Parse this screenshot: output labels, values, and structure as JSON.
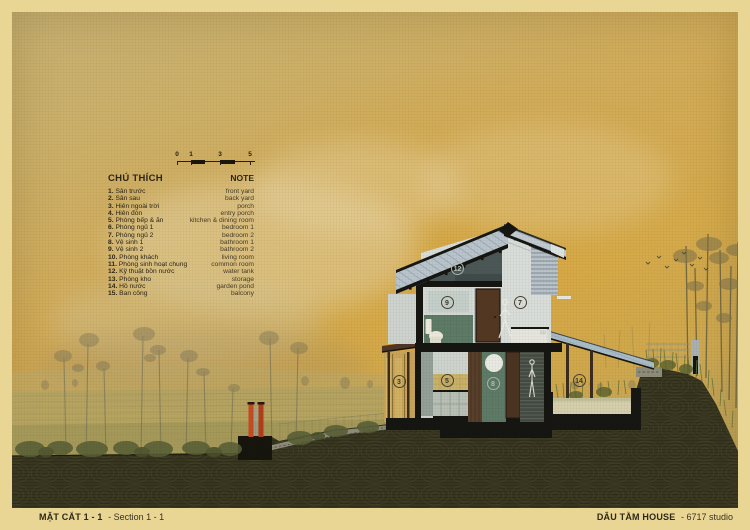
{
  "title_block": {
    "left_primary": "MẶT CẮT 1 - 1",
    "left_secondary": "- Section 1 - 1",
    "right_primary": "DÂU TẰM HOUSE",
    "right_secondary": "- 6717 studio"
  },
  "scalebar": {
    "labels": [
      "0",
      "1",
      "3",
      "5"
    ]
  },
  "legend": {
    "title_vi": "CHÚ THÍCH",
    "title_en": "NOTE",
    "items": [
      {
        "num": "1.",
        "vi": "Sân trước",
        "en": "front yard"
      },
      {
        "num": "2.",
        "vi": "Sân sau",
        "en": "back yard"
      },
      {
        "num": "3.",
        "vi": "Hiên ngoài trời",
        "en": "porch"
      },
      {
        "num": "4.",
        "vi": "Hiên đón",
        "en": "entry porch"
      },
      {
        "num": "5.",
        "vi": "Phòng bếp & ăn",
        "en": "kitchen & dining room"
      },
      {
        "num": "6.",
        "vi": "Phòng ngủ 1",
        "en": "bedroom 1"
      },
      {
        "num": "7.",
        "vi": "Phòng ngủ 2",
        "en": "bedroom 2"
      },
      {
        "num": "8.",
        "vi": "Vệ sinh 1",
        "en": "bathroom 1"
      },
      {
        "num": "9.",
        "vi": "Vệ sinh 2",
        "en": "bathroom 2"
      },
      {
        "num": "10.",
        "vi": "Phòng khách",
        "en": "living room"
      },
      {
        "num": "11.",
        "vi": "Phòng sinh hoạt chung",
        "en": "common room"
      },
      {
        "num": "12.",
        "vi": "Kỹ thuật bồn nước",
        "en": "water tank"
      },
      {
        "num": "13.",
        "vi": "Phòng kho",
        "en": "storage"
      },
      {
        "num": "14.",
        "vi": "Hồ nước",
        "en": "garden pond"
      },
      {
        "num": "15.",
        "vi": "Ban công",
        "en": "balcony"
      }
    ]
  },
  "markers": [
    {
      "n": "12",
      "room": "water tank"
    },
    {
      "n": "9",
      "room": "bathroom 2"
    },
    {
      "n": "7",
      "room": "bedroom 2"
    },
    {
      "n": "3",
      "room": "porch"
    },
    {
      "n": "5",
      "room": "kitchen & dining room"
    },
    {
      "n": "8",
      "room": "bathroom 1"
    },
    {
      "n": "14",
      "room": "garden pond"
    }
  ],
  "colors": {
    "paper_margin": "#e9d694",
    "sky_gold": "#d5ab4f",
    "ground_dark": "#2f2e1b",
    "roof_metal": "#b9c4cd",
    "gate_red": "#c64a22",
    "tile_green": "#5e7b67",
    "wood_brown": "#523722"
  }
}
